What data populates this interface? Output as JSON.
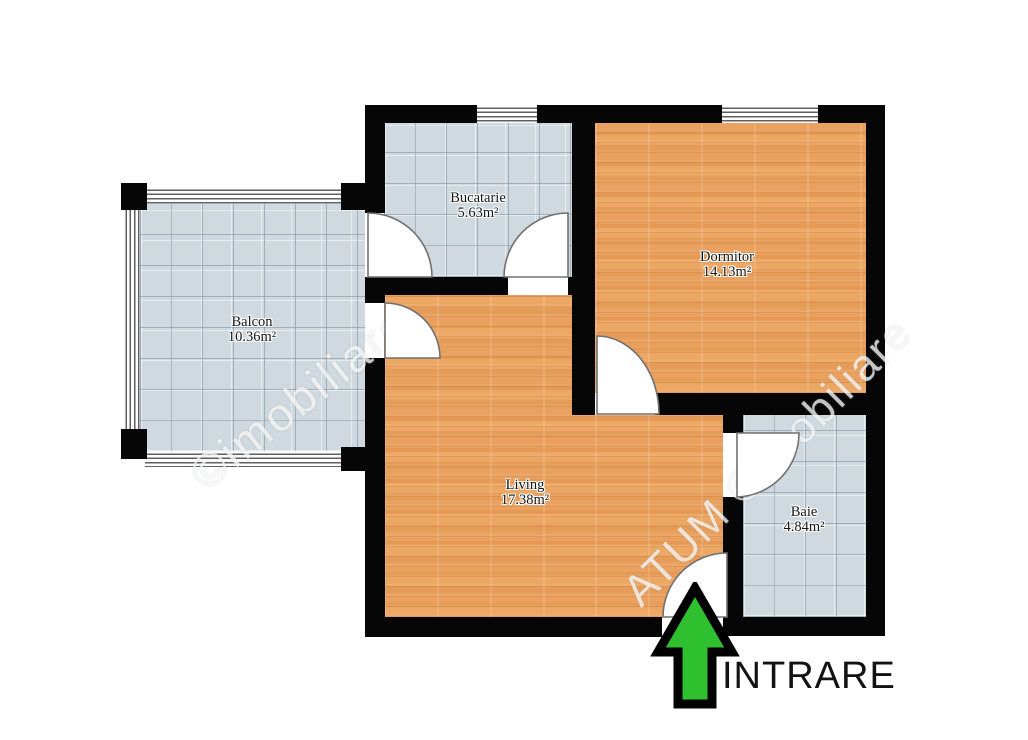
{
  "floor_plan": {
    "rooms": [
      {
        "name": "Bucatarie",
        "area": "5.63m²"
      },
      {
        "name": "Dormitor",
        "area": "14.13m²"
      },
      {
        "name": "Balcon",
        "area": "10.36m²"
      },
      {
        "name": "Living",
        "area": "17.38m²"
      },
      {
        "name": "Baie",
        "area": "4.84m²"
      }
    ],
    "entrance": {
      "label": "INTRARE",
      "arrow_direction": "up"
    },
    "watermarks": {
      "left": "©imobiliare",
      "right": "ATUM ©imobiliare"
    },
    "colors": {
      "wall": "#060606",
      "wood_floor": "#e9a15d",
      "tile_floor": "#cfd9df",
      "arrow_green": "#2fc02f",
      "entrance_text": "#121212"
    }
  }
}
